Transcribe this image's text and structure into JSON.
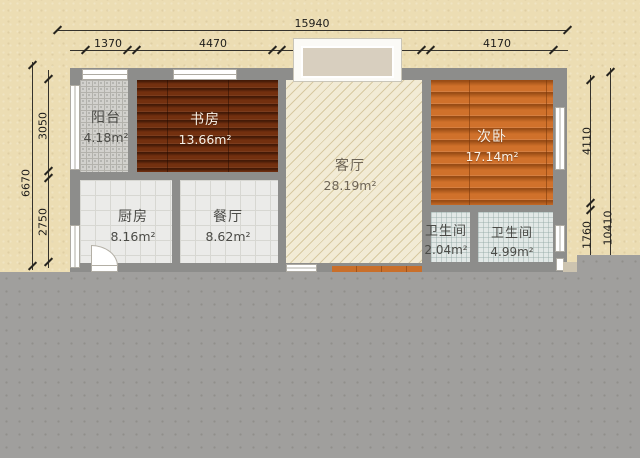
{
  "title": "apartment-floor-plan",
  "rooms": {
    "balcony": {
      "name": "阳台",
      "area": "4.18m²"
    },
    "study": {
      "name": "书房",
      "area": "13.66m²"
    },
    "living": {
      "name": "客厅",
      "area": "28.19m²"
    },
    "bedroom2": {
      "name": "次卧",
      "area": "17.14m²"
    },
    "kitchen": {
      "name": "厨房",
      "area": "8.16m²"
    },
    "dining": {
      "name": "餐厅",
      "area": "8.62m²"
    },
    "bath_small": {
      "name": "卫生间",
      "area": "2.04m²"
    },
    "bath_large": {
      "name": "卫生间",
      "area": "4.99m²"
    }
  },
  "dimensions": {
    "top": {
      "total": "15940",
      "segments": [
        "1370",
        "4470",
        "4640",
        "4170"
      ]
    },
    "left": {
      "total": "6670",
      "segments": [
        "3050",
        "2750"
      ]
    },
    "right": {
      "total": "10410",
      "segments": [
        "4110",
        "1760"
      ]
    }
  },
  "colors": {
    "background": "#ecddb3",
    "wall": "#8d8d8b",
    "study_floor": "#73300f",
    "bedroom_floor": "#d0712b",
    "living_floor": "#f2ebd5",
    "tile_floor": "#ebebe9",
    "bath_floor": "#e2e8e6",
    "overlay_gray": "#a09f9d"
  }
}
